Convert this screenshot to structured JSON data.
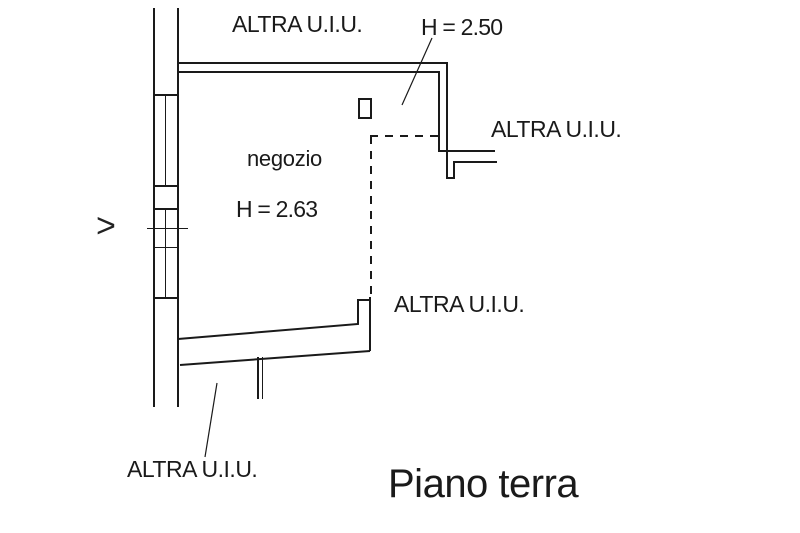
{
  "plan_title": "Piano terra",
  "room": {
    "name": "negozio",
    "height": "H = 2.63"
  },
  "annex": {
    "height": "H = 2.50"
  },
  "other_units": {
    "top": "ALTRA U.I.U.",
    "right": "ALTRA U.I.U.",
    "bottom": "ALTRA U.I.U.",
    "bottom_left": "ALTRA U.I.U."
  },
  "direction_marker": ">",
  "colors": {
    "line": "#1a1a1a",
    "background": "#ffffff"
  }
}
